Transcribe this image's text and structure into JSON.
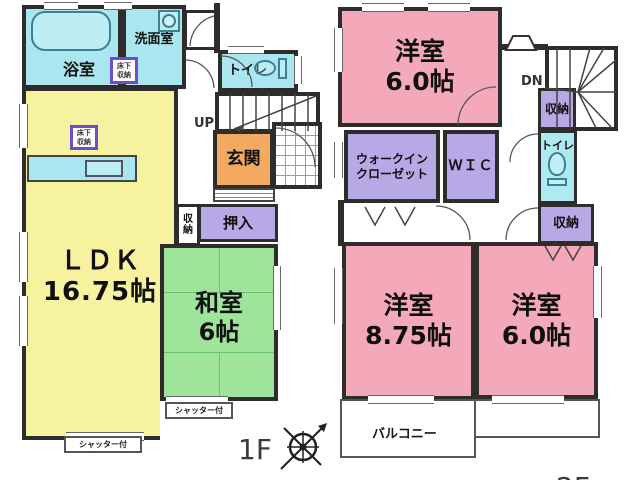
{
  "colors": {
    "wall": "#2e2d2b",
    "water_cyan": "#a9e6ef",
    "ldk_yellow": "#f6f2a0",
    "tatami_green": "#9fe49b",
    "bedroom_pink": "#f3a9b9",
    "closet_purple": "#b7a8e6",
    "entrance_orange": "#f3a95f"
  },
  "floor1": {
    "floor_label": "1F",
    "bath": "浴室",
    "washroom": "洗面室",
    "toilet": "トイレ",
    "underfloor_storage": "床下\n収納",
    "stairs_label": "UP",
    "entrance": "玄関",
    "storage": "収\n納",
    "oshiire": "押入",
    "ldk": "ＬＤＫ\n16.75帖",
    "japanese_room": "和室\n6帖",
    "shutter": "シャッター付"
  },
  "floor2": {
    "floor_label": "2F",
    "bedroom_top": "洋室\n6.0帖",
    "stairs_label": "DN",
    "storage_top": "収納",
    "toilet": "トイレ",
    "walkin_closet": "ウォークイン\nクローゼット",
    "wic": "ＷＩＣ",
    "bedroom_left": "洋室\n8.75帖",
    "bedroom_right": "洋室\n6.0帖",
    "storage_bottom": "収納",
    "balcony": "バルコニー"
  }
}
